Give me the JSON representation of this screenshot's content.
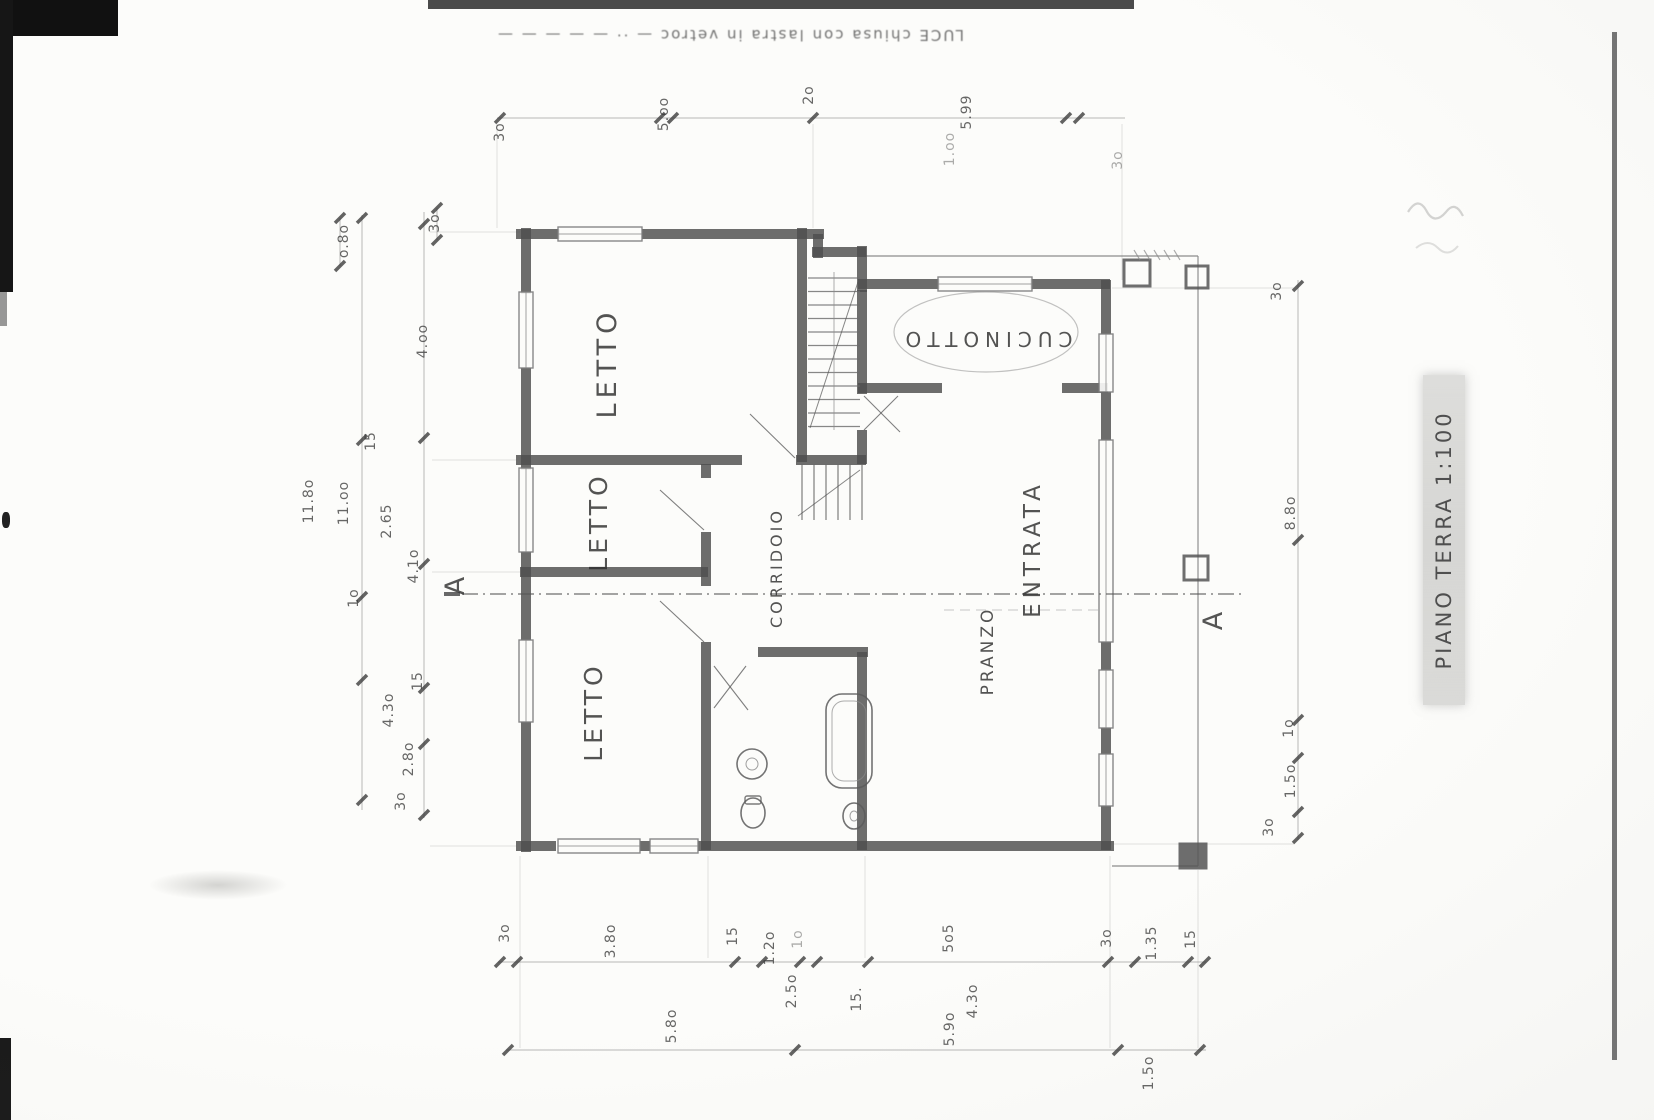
{
  "scan": {
    "flipped_note": "LUCE    chiusa con lastra in vetroc — ·· — — — — —",
    "scale_band_label": "PIANO TERRA 1:100"
  },
  "plan": {
    "rooms": [
      {
        "id": "letto-1",
        "label": "LETTO",
        "x": 616,
        "y": 363,
        "rot": -90,
        "size": 27,
        "ls": 5
      },
      {
        "id": "letto-2",
        "label": "LETTO",
        "x": 607,
        "y": 522,
        "rot": -90,
        "size": 25,
        "ls": 4
      },
      {
        "id": "letto-3",
        "label": "LETTO",
        "x": 602,
        "y": 712,
        "rot": -90,
        "size": 25,
        "ls": 4
      },
      {
        "id": "corridoio",
        "label": "CORRIDOIO",
        "x": 782,
        "y": 568,
        "rot": -90,
        "size": 16,
        "ls": 3
      },
      {
        "id": "cucinotto",
        "label": "CUCINOTTO",
        "x": 986,
        "y": 332,
        "rot": 180,
        "size": 20,
        "ls": 6
      },
      {
        "id": "entrata",
        "label": "ENTRATA",
        "x": 1040,
        "y": 549,
        "rot": -90,
        "size": 23,
        "ls": 5
      },
      {
        "id": "pranzo",
        "label": "PRANZO",
        "x": 993,
        "y": 651,
        "rot": -90,
        "size": 17,
        "ls": 3
      }
    ],
    "section_markers": [
      {
        "id": "a-left",
        "label": "A",
        "x": 464,
        "y": 586,
        "rot": -90
      },
      {
        "id": "a-right",
        "label": "A",
        "x": 1222,
        "y": 621,
        "rot": -90
      }
    ],
    "dimensions": [
      {
        "label": "3o",
        "x": 504,
        "y": 132
      },
      {
        "label": "5.oo",
        "x": 668,
        "y": 114
      },
      {
        "label": "2o",
        "x": 813,
        "y": 95
      },
      {
        "label": "5.99",
        "x": 971,
        "y": 112
      },
      {
        "label": "1.oo",
        "x": 954,
        "y": 149,
        "faint": true
      },
      {
        "label": "3o",
        "x": 1122,
        "y": 160,
        "faint": true
      },
      {
        "label": "o.8o",
        "x": 348,
        "y": 241
      },
      {
        "label": "3o",
        "x": 439,
        "y": 223
      },
      {
        "label": "4.oo",
        "x": 427,
        "y": 341
      },
      {
        "label": "15",
        "x": 375,
        "y": 441
      },
      {
        "label": "11.8o",
        "x": 313,
        "y": 501
      },
      {
        "label": "11.oo",
        "x": 348,
        "y": 503
      },
      {
        "label": "2.65",
        "x": 391,
        "y": 521
      },
      {
        "label": "4.1o",
        "x": 418,
        "y": 566
      },
      {
        "label": "1o",
        "x": 358,
        "y": 598
      },
      {
        "label": "15",
        "x": 422,
        "y": 681
      },
      {
        "label": "4.3o",
        "x": 393,
        "y": 710
      },
      {
        "label": "2.8o",
        "x": 413,
        "y": 759
      },
      {
        "label": "3o",
        "x": 405,
        "y": 801
      },
      {
        "label": "3o",
        "x": 1281,
        "y": 291
      },
      {
        "label": "8.8o",
        "x": 1295,
        "y": 513
      },
      {
        "label": "1o",
        "x": 1293,
        "y": 728
      },
      {
        "label": "1.5o",
        "x": 1295,
        "y": 781
      },
      {
        "label": "3o",
        "x": 1273,
        "y": 827
      },
      {
        "label": "3o",
        "x": 509,
        "y": 933
      },
      {
        "label": "3.8o",
        "x": 615,
        "y": 941
      },
      {
        "label": "15",
        "x": 737,
        "y": 936
      },
      {
        "label": "1.2o",
        "x": 774,
        "y": 948
      },
      {
        "label": "1o",
        "x": 802,
        "y": 939,
        "faint": true
      },
      {
        "label": "2.5o",
        "x": 796,
        "y": 991
      },
      {
        "label": "15.",
        "x": 861,
        "y": 999
      },
      {
        "label": "5o5",
        "x": 953,
        "y": 938
      },
      {
        "label": "4.3o",
        "x": 977,
        "y": 1001
      },
      {
        "label": "3o",
        "x": 1111,
        "y": 938
      },
      {
        "label": "1.35",
        "x": 1156,
        "y": 943
      },
      {
        "label": "15",
        "x": 1195,
        "y": 939
      },
      {
        "label": "5.8o",
        "x": 676,
        "y": 1026
      },
      {
        "label": "5.9o",
        "x": 954,
        "y": 1029
      },
      {
        "label": "1.5o",
        "x": 1153,
        "y": 1073
      }
    ]
  }
}
